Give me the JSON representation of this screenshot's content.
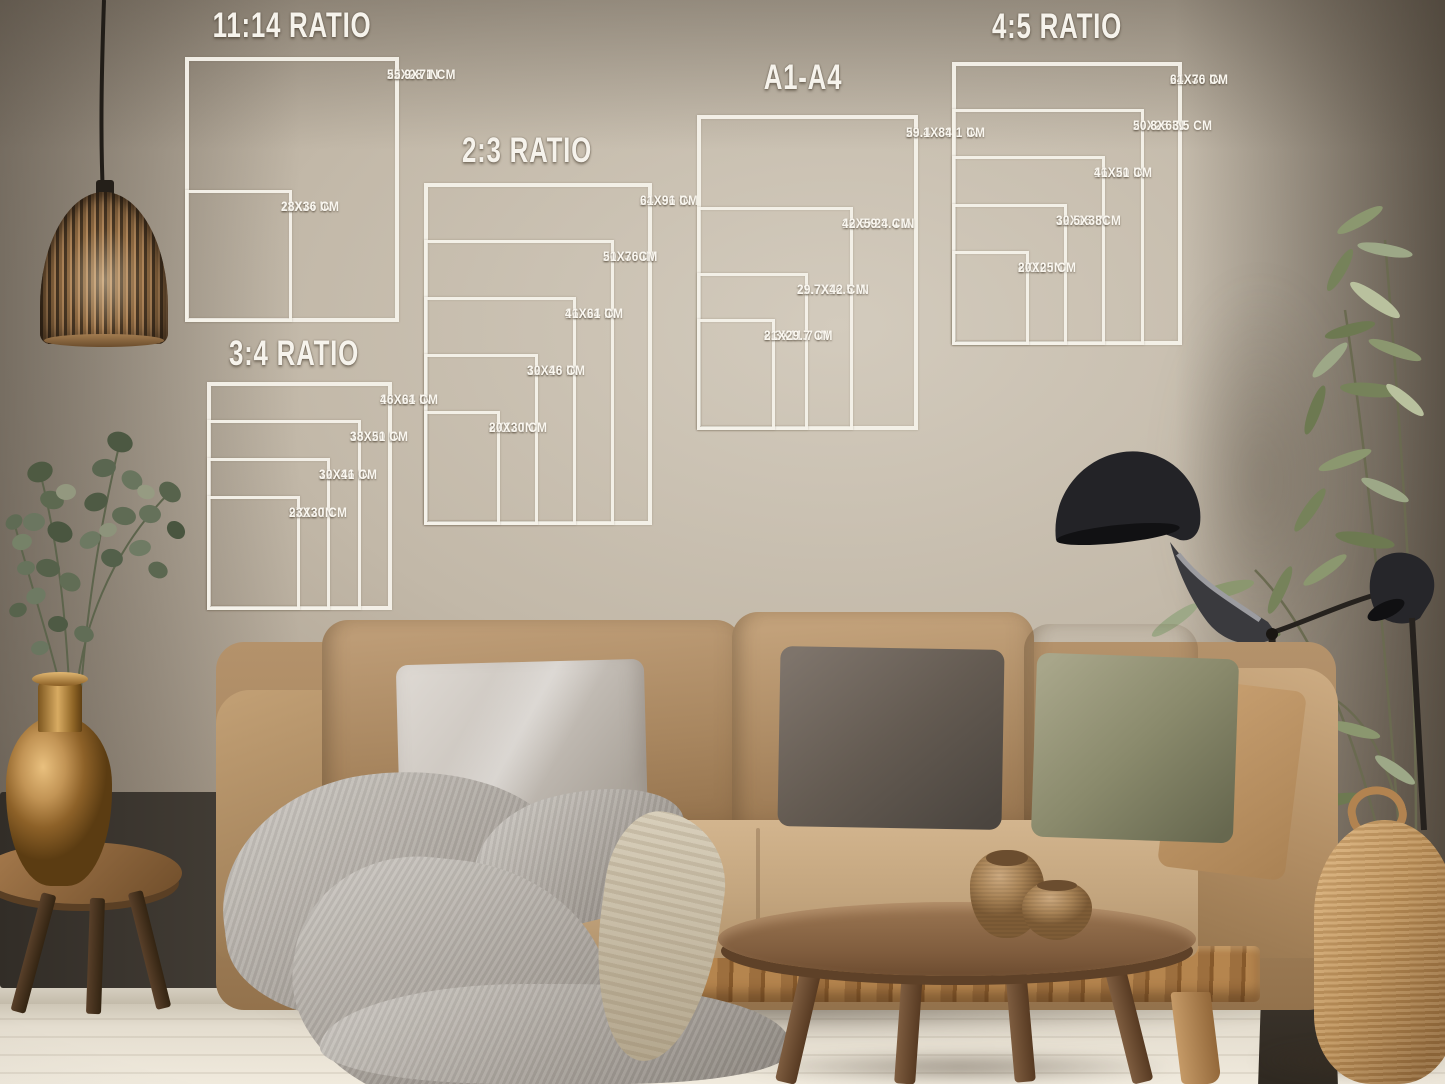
{
  "scene": {
    "description": "Living room photograph used as a wall-art print size guide mockup",
    "palette": {
      "wall": "#b3a898",
      "sofa": "#ad8a61",
      "pillow_light_gray": "#ccc6bf",
      "pillow_dark_gray": "#5f574f",
      "pillow_olive": "#8a8a6c",
      "wood": "#8a6a4a",
      "chart_line": "#f4f0e8",
      "chart_text": "#faf7f0"
    }
  },
  "size_charts": [
    {
      "title": "11:14 RATIO",
      "sizes": [
        {
          "w": 22,
          "h": 28,
          "in_label": "22X28 IN",
          "cm_label": "55.9X71 CM"
        },
        {
          "w": 11,
          "h": 14,
          "in_label": "11X14 IN",
          "cm_label": "28X36 CM"
        }
      ]
    },
    {
      "title": "2:3 RATIO",
      "sizes": [
        {
          "w": 24,
          "h": 36,
          "in_label": "24X36 IN",
          "cm_label": "61X91 CM"
        },
        {
          "w": 20,
          "h": 30,
          "in_label": "20X30 IN",
          "cm_label": "51X76CM"
        },
        {
          "w": 16,
          "h": 24,
          "in_label": "16X24 IN",
          "cm_label": "41X61 CM"
        },
        {
          "w": 12,
          "h": 18,
          "in_label": "12X18 IN",
          "cm_label": "30X46 CM"
        },
        {
          "w": 8,
          "h": 12,
          "in_label": "8X12 IN",
          "cm_label": "20X30 CM"
        }
      ]
    },
    {
      "title": "3:4 RATIO",
      "sizes": [
        {
          "w": 18,
          "h": 24,
          "in_label": "18X24 IN",
          "cm_label": "46X61 CM"
        },
        {
          "w": 15,
          "h": 20,
          "in_label": "15X20 IN",
          "cm_label": "38X51 CM"
        },
        {
          "w": 12,
          "h": 16,
          "in_label": "12X16 IN",
          "cm_label": "30X41 CM"
        },
        {
          "w": 9,
          "h": 12,
          "in_label": "9X12 IN",
          "cm_label": "23X30 CM"
        }
      ]
    },
    {
      "title": "A1-A4",
      "sizes": [
        {
          "w": 23.4,
          "h": 33.1,
          "in_label": "23.4X33.1 IN",
          "cm_label": "59.1X84.1 CM"
        },
        {
          "w": 16.5,
          "h": 23.4,
          "in_label": "16.5X23.4 IN",
          "cm_label": "42X59.4 CM"
        },
        {
          "w": 11.7,
          "h": 16.5,
          "in_label": "11.7X16.5 IN",
          "cm_label": "29.7X42 CM"
        },
        {
          "w": 8.3,
          "h": 11.7,
          "in_label": "8.3X11.7 IN",
          "cm_label": "21X29.7 CM"
        }
      ]
    },
    {
      "title": "4:5 RATIO",
      "sizes": [
        {
          "w": 24,
          "h": 30,
          "in_label": "24X30 IN",
          "cm_label": "61X76 CM"
        },
        {
          "w": 20,
          "h": 25,
          "in_label": "20X25 IN",
          "cm_label": "50.8X63.5 CM"
        },
        {
          "w": 16,
          "h": 20,
          "in_label": "16X20 IN",
          "cm_label": "41X51 CM"
        },
        {
          "w": 12,
          "h": 15,
          "in_label": "12X15 IN",
          "cm_label": "30.5X38CM"
        },
        {
          "w": 8,
          "h": 10,
          "in_label": "8X10 IN",
          "cm_label": "20X25 CM"
        }
      ]
    }
  ]
}
